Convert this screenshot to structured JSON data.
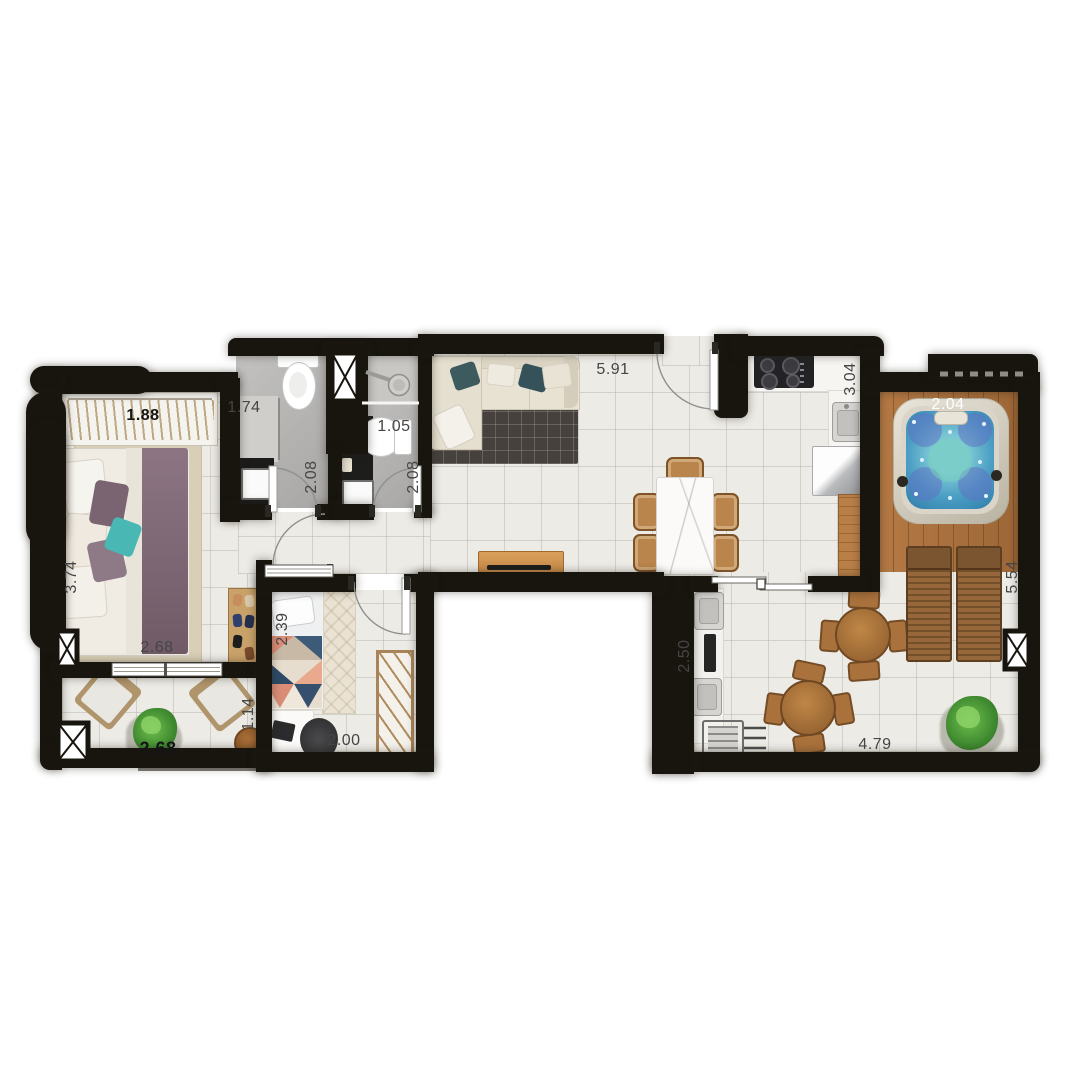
{
  "plan": {
    "type": "apartment-floor-plan-top-view",
    "labels": [
      {
        "name": "master-closet-width",
        "value": "1.88",
        "bold": true
      },
      {
        "name": "bath1-width",
        "value": "1.74"
      },
      {
        "name": "bath2-width",
        "value": "1.05"
      },
      {
        "name": "living-room-width",
        "value": "5.91"
      },
      {
        "name": "kitchen-depth",
        "value": "3.04"
      },
      {
        "name": "spa-deck-width",
        "value": "2.04",
        "color": "#ffffff"
      },
      {
        "name": "bath1-depth",
        "value": "2.08"
      },
      {
        "name": "bath2-depth",
        "value": "2.08"
      },
      {
        "name": "master-bedroom-depth",
        "value": "3.74"
      },
      {
        "name": "master-bedroom-width",
        "value": "2.68"
      },
      {
        "name": "balcony-width",
        "value": "2.68",
        "bold": true
      },
      {
        "name": "balcony-depth",
        "value": "1.14"
      },
      {
        "name": "bedroom2-bed-length",
        "value": "2.39"
      },
      {
        "name": "bedroom2-width",
        "value": "2.00"
      },
      {
        "name": "grill-area-depth",
        "value": "2.50"
      },
      {
        "name": "terrace-depth",
        "value": "5.54"
      },
      {
        "name": "terrace-width",
        "value": "4.79"
      }
    ],
    "furniture": [
      "double-bed",
      "wardrobe-with-hangers",
      "shoe-rack",
      "toilet",
      "shower",
      "vanity-sink",
      "l-shaped-sofa",
      "area-rug",
      "tv-console",
      "dining-table",
      "dining-chair",
      "cooktop",
      "kitchen-sink",
      "refrigerator",
      "bar-counter",
      "hot-tub",
      "sun-lounger",
      "round-table",
      "barbecue-grill",
      "outdoor-sink",
      "armchair",
      "side-table",
      "potted-plant",
      "single-bed",
      "desk",
      "office-chair",
      "open-wardrobe"
    ],
    "colors": {
      "wall": "#17150e",
      "floor_tile": "#edebe6",
      "bathroom_floor": "#b5b4b2",
      "deck_wood": "#a8703d",
      "hot_tub_water": "#3f8fc0",
      "dimension_label": "#454545"
    }
  }
}
